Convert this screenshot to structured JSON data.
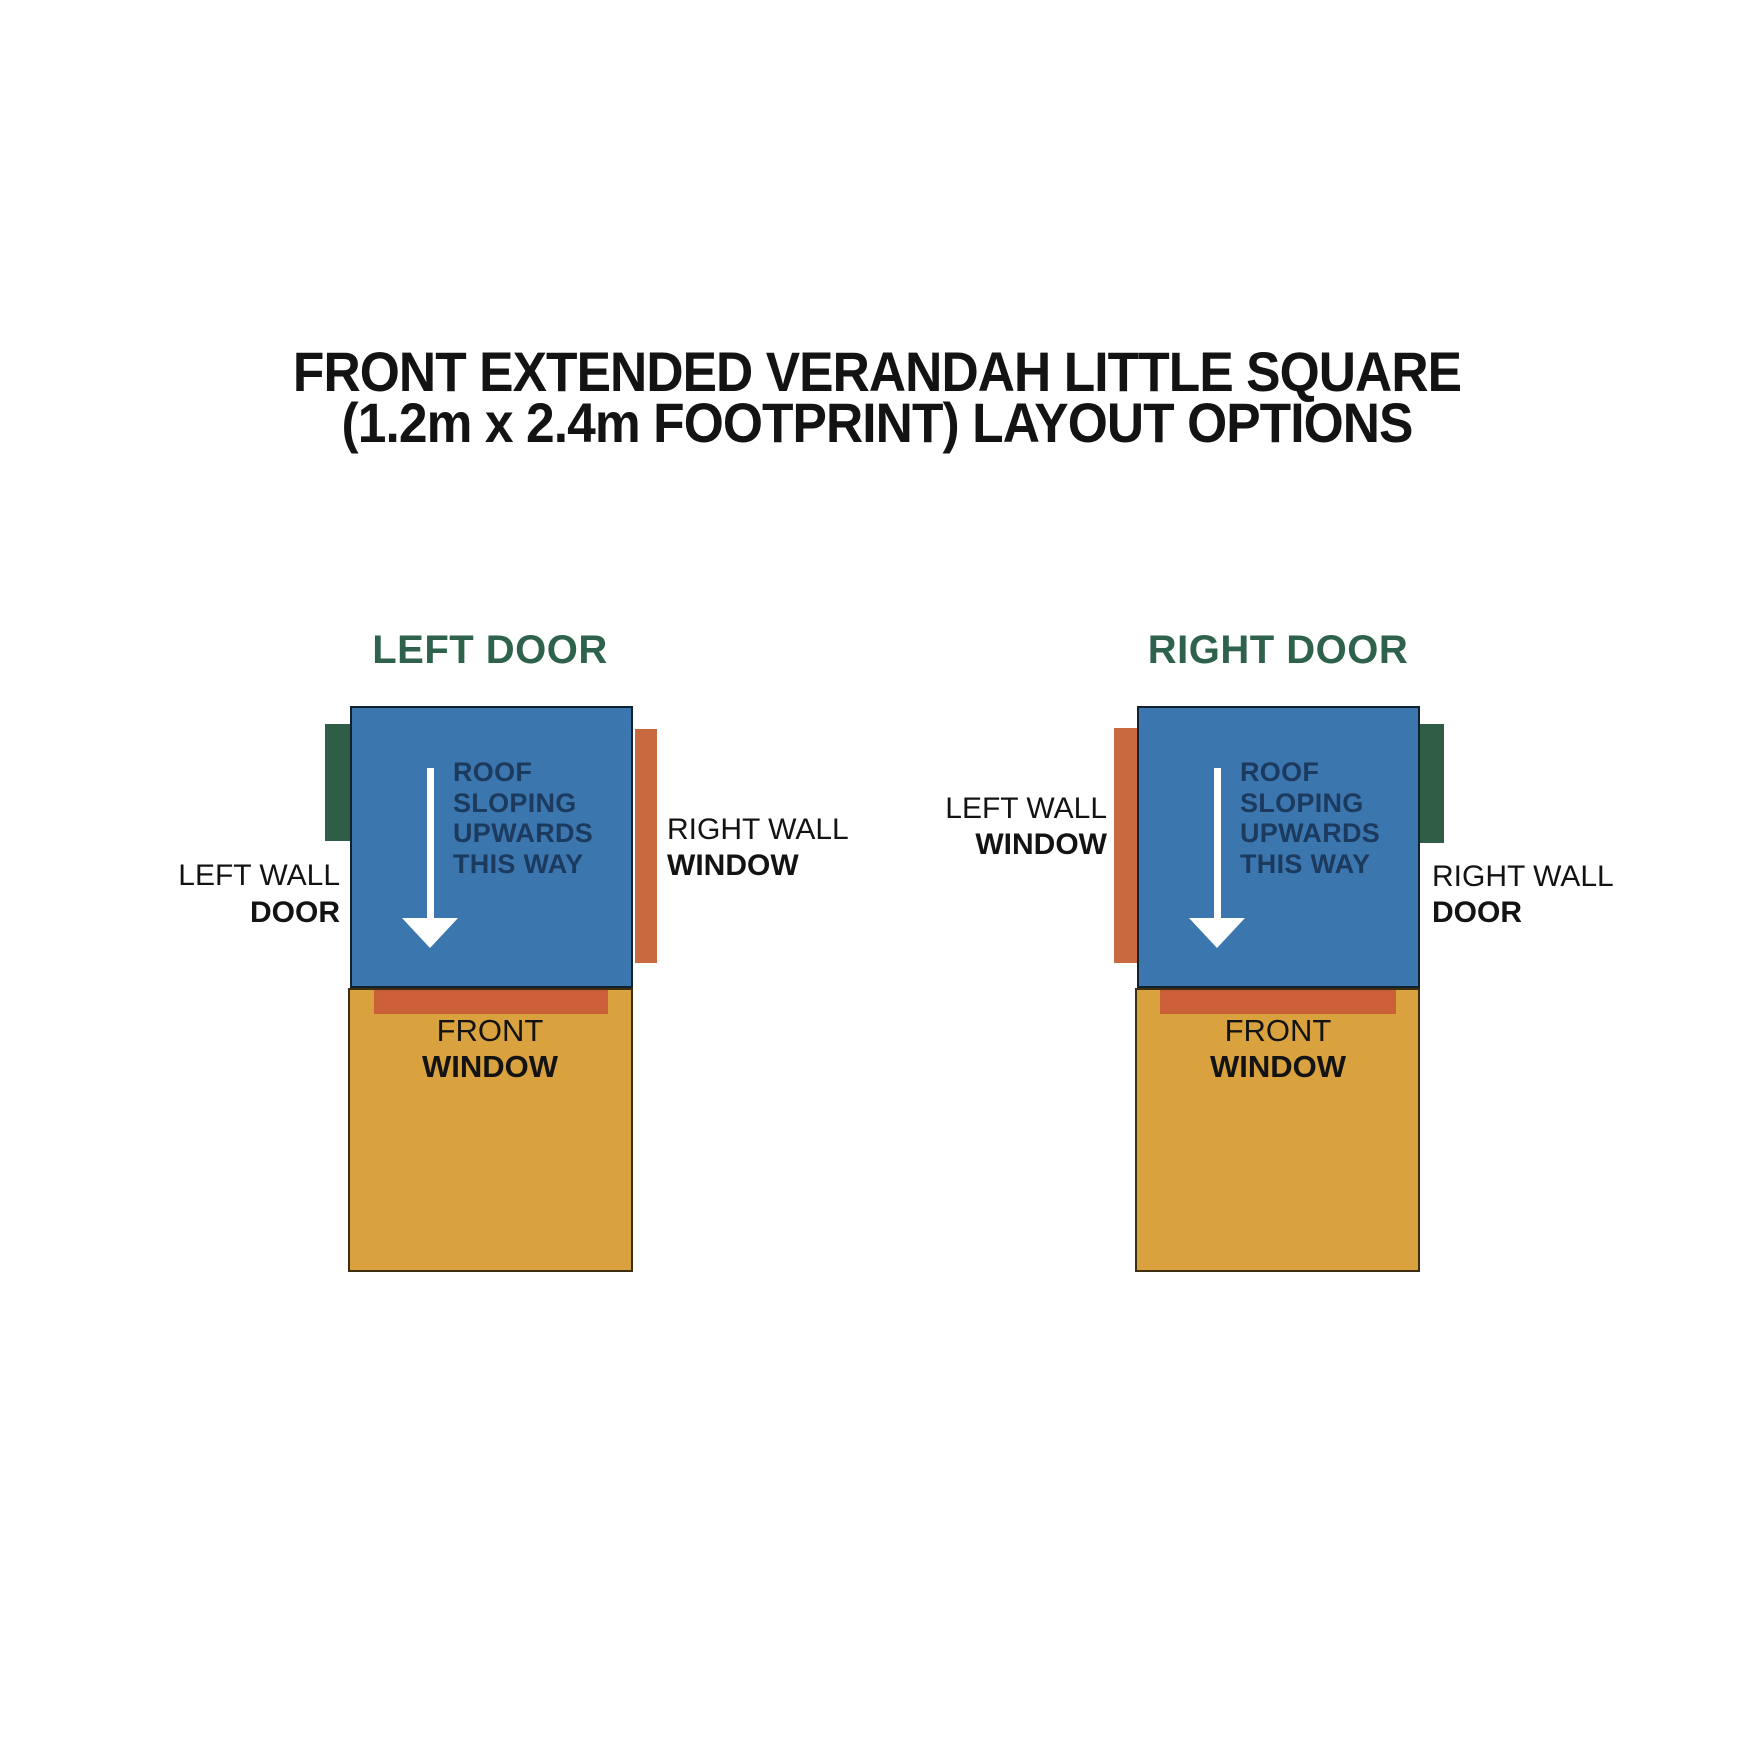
{
  "title": {
    "line1": "FRONT EXTENDED VERANDAH LITTLE SQUARE",
    "line2": "(1.2m x 2.4m FOOTPRINT) LAYOUT OPTIONS"
  },
  "colors": {
    "roof_blue": "#3B76AE",
    "verandah_tan": "#D9A23F",
    "door_green": "#2F5D45",
    "window_orange": "#C8693F",
    "front_window_orange": "#CB5F38",
    "heading_green": "#2F624C",
    "roof_note_navy": "#1C3A5E",
    "label_black": "#131313"
  },
  "options": [
    {
      "heading": "LEFT DOOR",
      "roof_note": [
        "ROOF",
        "SLOPING",
        "UPWARDS",
        "THIS WAY"
      ],
      "left_wall": {
        "wall": "LEFT WALL",
        "feature": "DOOR"
      },
      "right_wall": {
        "wall": "RIGHT WALL",
        "feature": "WINDOW"
      },
      "front": {
        "line1": "FRONT",
        "line2": "WINDOW"
      }
    },
    {
      "heading": "RIGHT DOOR",
      "roof_note": [
        "ROOF",
        "SLOPING",
        "UPWARDS",
        "THIS WAY"
      ],
      "left_wall": {
        "wall": "LEFT WALL",
        "feature": "WINDOW"
      },
      "right_wall": {
        "wall": "RIGHT WALL",
        "feature": "DOOR"
      },
      "front": {
        "line1": "FRONT",
        "line2": "WINDOW"
      }
    }
  ]
}
